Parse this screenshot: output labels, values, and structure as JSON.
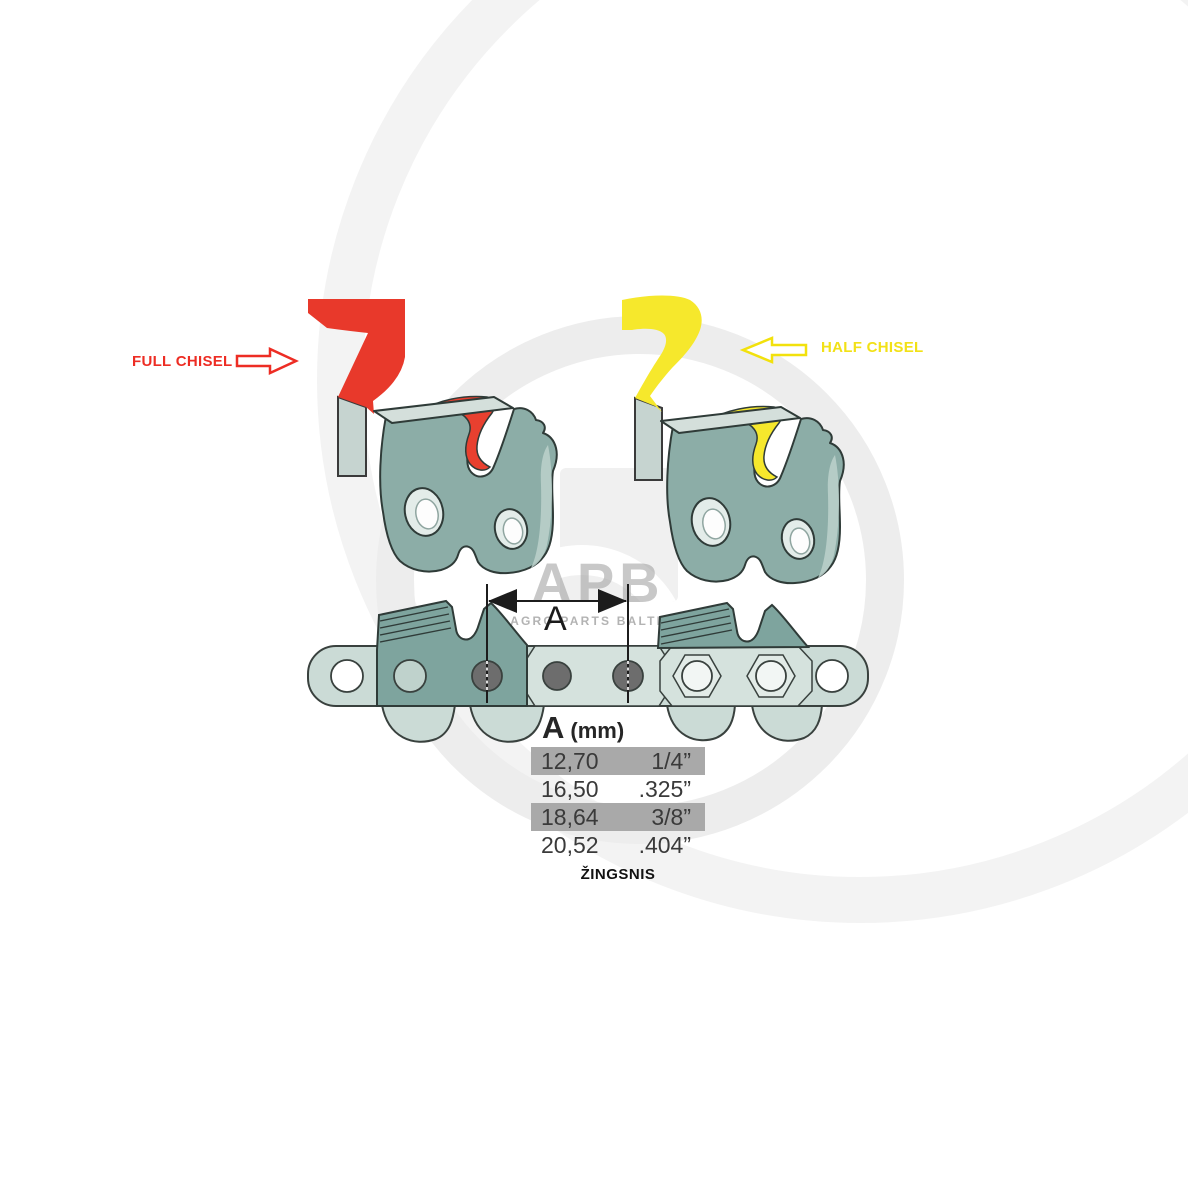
{
  "watermark": {
    "monogram": "APB",
    "caption": "AGRO PARTS BALTIJA"
  },
  "annotations": {
    "full_chisel": "FULL CHISEL",
    "half_chisel": "HALF CHISEL",
    "dimension_symbol": "A"
  },
  "pitch_table": {
    "header": {
      "symbol": "A",
      "unit": "(mm)"
    },
    "rows": [
      {
        "mm": "12,70",
        "inch": "1/4”",
        "highlighted": true
      },
      {
        "mm": "16,50",
        "inch": ".325”",
        "highlighted": false
      },
      {
        "mm": "18,64",
        "inch": "3/8”",
        "highlighted": true
      },
      {
        "mm": "20,52",
        "inch": ".404”",
        "highlighted": false
      }
    ],
    "footer": "ŽINGSNIS"
  },
  "colors": {
    "full_chisel_accent": "#ed2d24",
    "half_chisel_accent": "#f5e71a",
    "cutter_body_teal": "#8cada7",
    "chain_plate_light": "#cbdbd6",
    "table_row_highlight": "#a9a9a9",
    "rivet_gray": "#6d6d6d"
  }
}
